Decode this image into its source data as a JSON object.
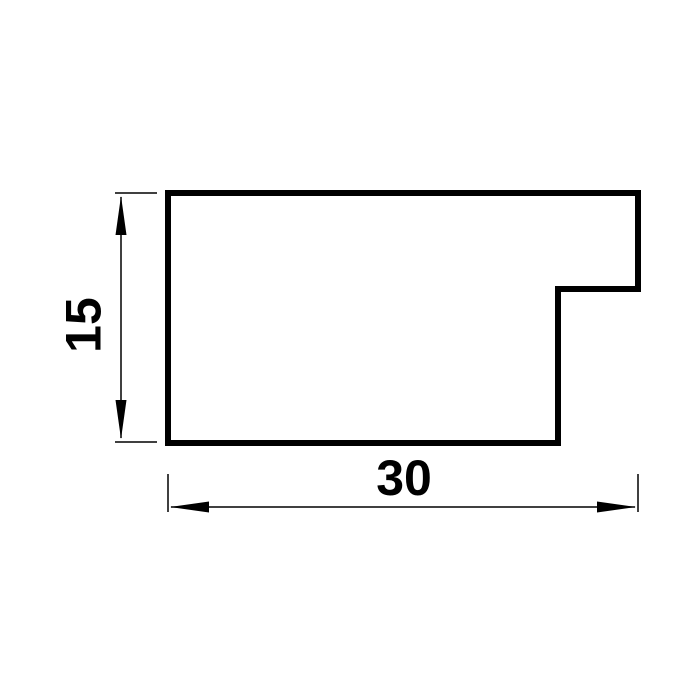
{
  "page": {
    "background_color": "#ffffff",
    "line_color": "#000000"
  },
  "drawing": {
    "kind": "technical-cross-section-profile",
    "description": "Stepped rectangular moulding profile with rabbet notch at lower right",
    "dimensions": {
      "width": {
        "value": "30",
        "orientation": "horizontal",
        "arrow_style": "outward-pointing"
      },
      "height": {
        "value": "15",
        "orientation": "vertical",
        "arrow_style": "outward-pointing"
      }
    }
  }
}
